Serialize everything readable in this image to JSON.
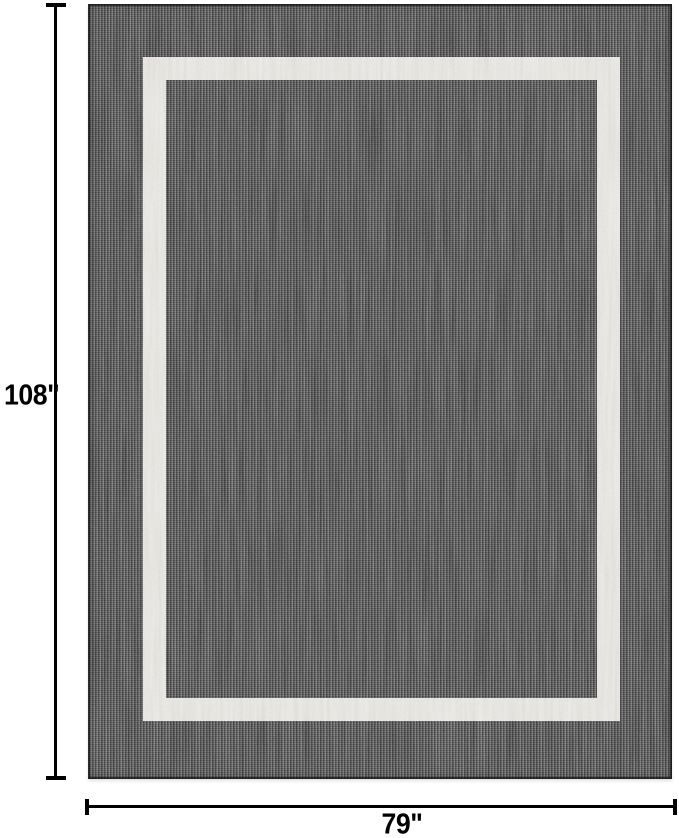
{
  "figure": {
    "background_color": "#ffffff",
    "rug": {
      "type": "bordered-area-rug",
      "field_color": "#4a4a4a",
      "band_color": "#dcd9d3",
      "edge_color": "#0e0e0e"
    },
    "annotations": {
      "line_color": "#000000",
      "height_label": "108\"",
      "width_label": "79\""
    }
  }
}
